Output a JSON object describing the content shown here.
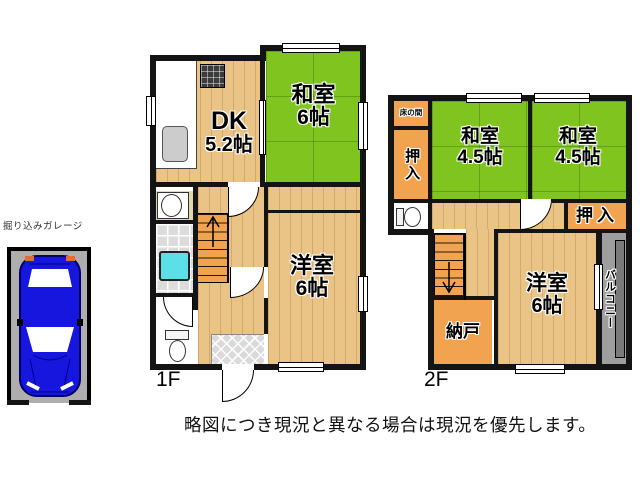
{
  "disclaimer": "略図につき現況と異なる場合は現況を優先します。",
  "garage": {
    "label": "掘り込みガレージ"
  },
  "floor1": {
    "label": "1F",
    "rooms": {
      "dk": {
        "name": "DK",
        "size": "5.2帖"
      },
      "washitsu": {
        "name": "和室",
        "size": "6帖"
      },
      "youshitsu": {
        "name": "洋室",
        "size": "6帖"
      }
    }
  },
  "floor2": {
    "label": "2F",
    "rooms": {
      "tokonoma": {
        "label": "床の間"
      },
      "oshiire_left": {
        "label": "押入"
      },
      "washitsu_a": {
        "name": "和室",
        "size": "4.5帖"
      },
      "washitsu_b": {
        "name": "和室",
        "size": "4.5帖"
      },
      "oshiire_right": {
        "label": "押入"
      },
      "nando": {
        "label": "納戸"
      },
      "youshitsu": {
        "name": "洋室",
        "size": "6帖"
      },
      "balcony": {
        "label": "バルコニー"
      }
    }
  },
  "colors": {
    "wall": "#141414",
    "wood": "#EAC487",
    "tatami": "#80C41F",
    "closet": "#F2A350",
    "tile": "#DCDCDC",
    "tub": "#5CE0E8",
    "sanitary": "#DFD9AC",
    "genkan": "#DADADA",
    "balcony": "#9E9E9E",
    "balcony_rail": "#7A7A7A",
    "garage": "#AFAEAC",
    "car": "#1616DE",
    "text": "#111111"
  }
}
